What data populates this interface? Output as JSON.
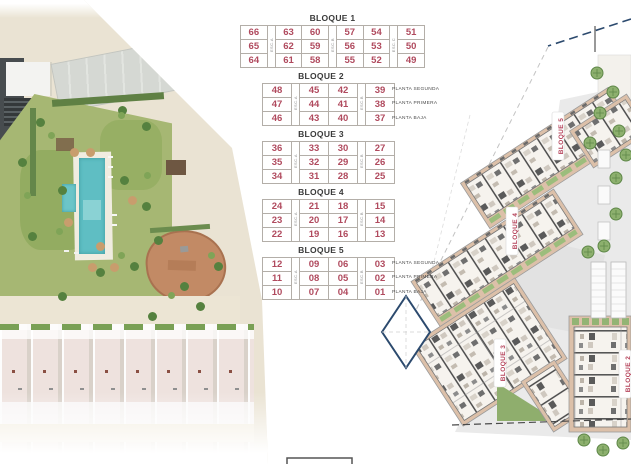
{
  "tables": {
    "blocks": [
      {
        "title": "BLOQUE 1",
        "stairs": [
          "ESC.A",
          "ESC.B",
          "ESC.C"
        ],
        "rows": [
          [
            "66",
            "63",
            "60",
            "57",
            "54",
            "51"
          ],
          [
            "65",
            "62",
            "59",
            "56",
            "53",
            "50"
          ],
          [
            "64",
            "61",
            "58",
            "55",
            "52",
            "49"
          ]
        ],
        "floors": []
      },
      {
        "title": "BLOQUE 2",
        "stairs": [
          "ESC.A",
          "ESC.B"
        ],
        "rows": [
          [
            "48",
            "45",
            "42",
            "39"
          ],
          [
            "47",
            "44",
            "41",
            "38"
          ],
          [
            "46",
            "43",
            "40",
            "37"
          ]
        ],
        "floors": [
          "PLANTA SEGUNDA",
          "PLANTA PRIMERA",
          "PLANTA BAJA"
        ]
      },
      {
        "title": "BLOQUE 3",
        "stairs": [
          "ESC.A",
          "ESC.B"
        ],
        "rows": [
          [
            "36",
            "33",
            "30",
            "27"
          ],
          [
            "35",
            "32",
            "29",
            "26"
          ],
          [
            "34",
            "31",
            "28",
            "25"
          ]
        ],
        "floors": []
      },
      {
        "title": "BLOQUE 4",
        "stairs": [
          "ESC.A",
          "ESC.B"
        ],
        "rows": [
          [
            "24",
            "21",
            "18",
            "15"
          ],
          [
            "23",
            "20",
            "17",
            "14"
          ],
          [
            "22",
            "19",
            "16",
            "13"
          ]
        ],
        "floors": []
      },
      {
        "title": "BLOQUE 5",
        "stairs": [
          "ESC.A",
          "ESC.B"
        ],
        "rows": [
          [
            "12",
            "09",
            "06",
            "03"
          ],
          [
            "11",
            "08",
            "05",
            "02"
          ],
          [
            "10",
            "07",
            "04",
            "01"
          ]
        ],
        "floors": [
          "PLANTA SEGUNDA",
          "PLANTA PRIMERA",
          "PLANTA BAJA"
        ]
      }
    ]
  },
  "plan": {
    "labels": [
      "BLOQUE 5",
      "BLOQUE 4",
      "BLOQUE 3",
      "BLOQUE 2"
    ]
  },
  "colors": {
    "unit_number": "#b04a5e",
    "block_title": "#3a3a3a",
    "floor_label": "#4a4a4a",
    "plan_label": "#b5435a",
    "boundary_blue": "#2c4a6e",
    "building_tan": "#dcc0a9",
    "lawn_green": "#a6b773",
    "pool_teal": "#5fbec3",
    "playground_brown": "#c28a65"
  }
}
